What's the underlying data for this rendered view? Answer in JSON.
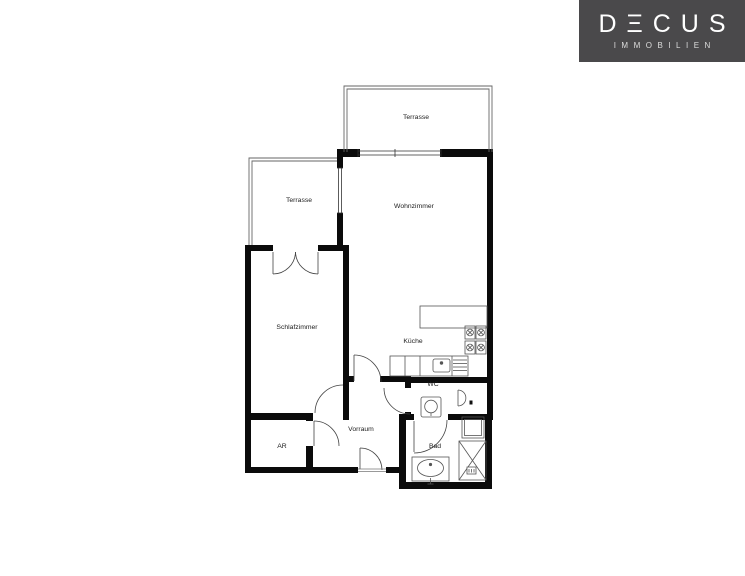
{
  "logo": {
    "wordmark": "DΞCUS",
    "subtitle": "IMMOBILIEN",
    "background_color": "#4a494b",
    "text_color": "#ffffff"
  },
  "floor_plan": {
    "type": "apartment-floor-plan",
    "line_colors": {
      "wall": "#0b0b0b",
      "thin_line": "#555555"
    },
    "rooms": [
      {
        "id": "terrasse-top",
        "label": "Terrasse"
      },
      {
        "id": "terrasse-left",
        "label": "Terrasse"
      },
      {
        "id": "wohnzimmer",
        "label": "Wohnzimmer"
      },
      {
        "id": "schlafzimmer",
        "label": "Schlafzimmer"
      },
      {
        "id": "kueche",
        "label": "Küche"
      },
      {
        "id": "wc",
        "label": "WC"
      },
      {
        "id": "vorraum",
        "label": "Vorraum"
      },
      {
        "id": "ar",
        "label": "AR"
      },
      {
        "id": "bad",
        "label": "Bad"
      }
    ],
    "fixtures": [
      "stove-icon",
      "kitchen-sink-icon",
      "kitchen-counter",
      "dishwasher-icon",
      "toilet-icon",
      "wc-basin-icon",
      "washbasin-icon",
      "shower-icon",
      "washing-machine-icon",
      "door-swing-icon",
      "french-door-icon",
      "window-icon",
      "terrace-railing"
    ]
  }
}
